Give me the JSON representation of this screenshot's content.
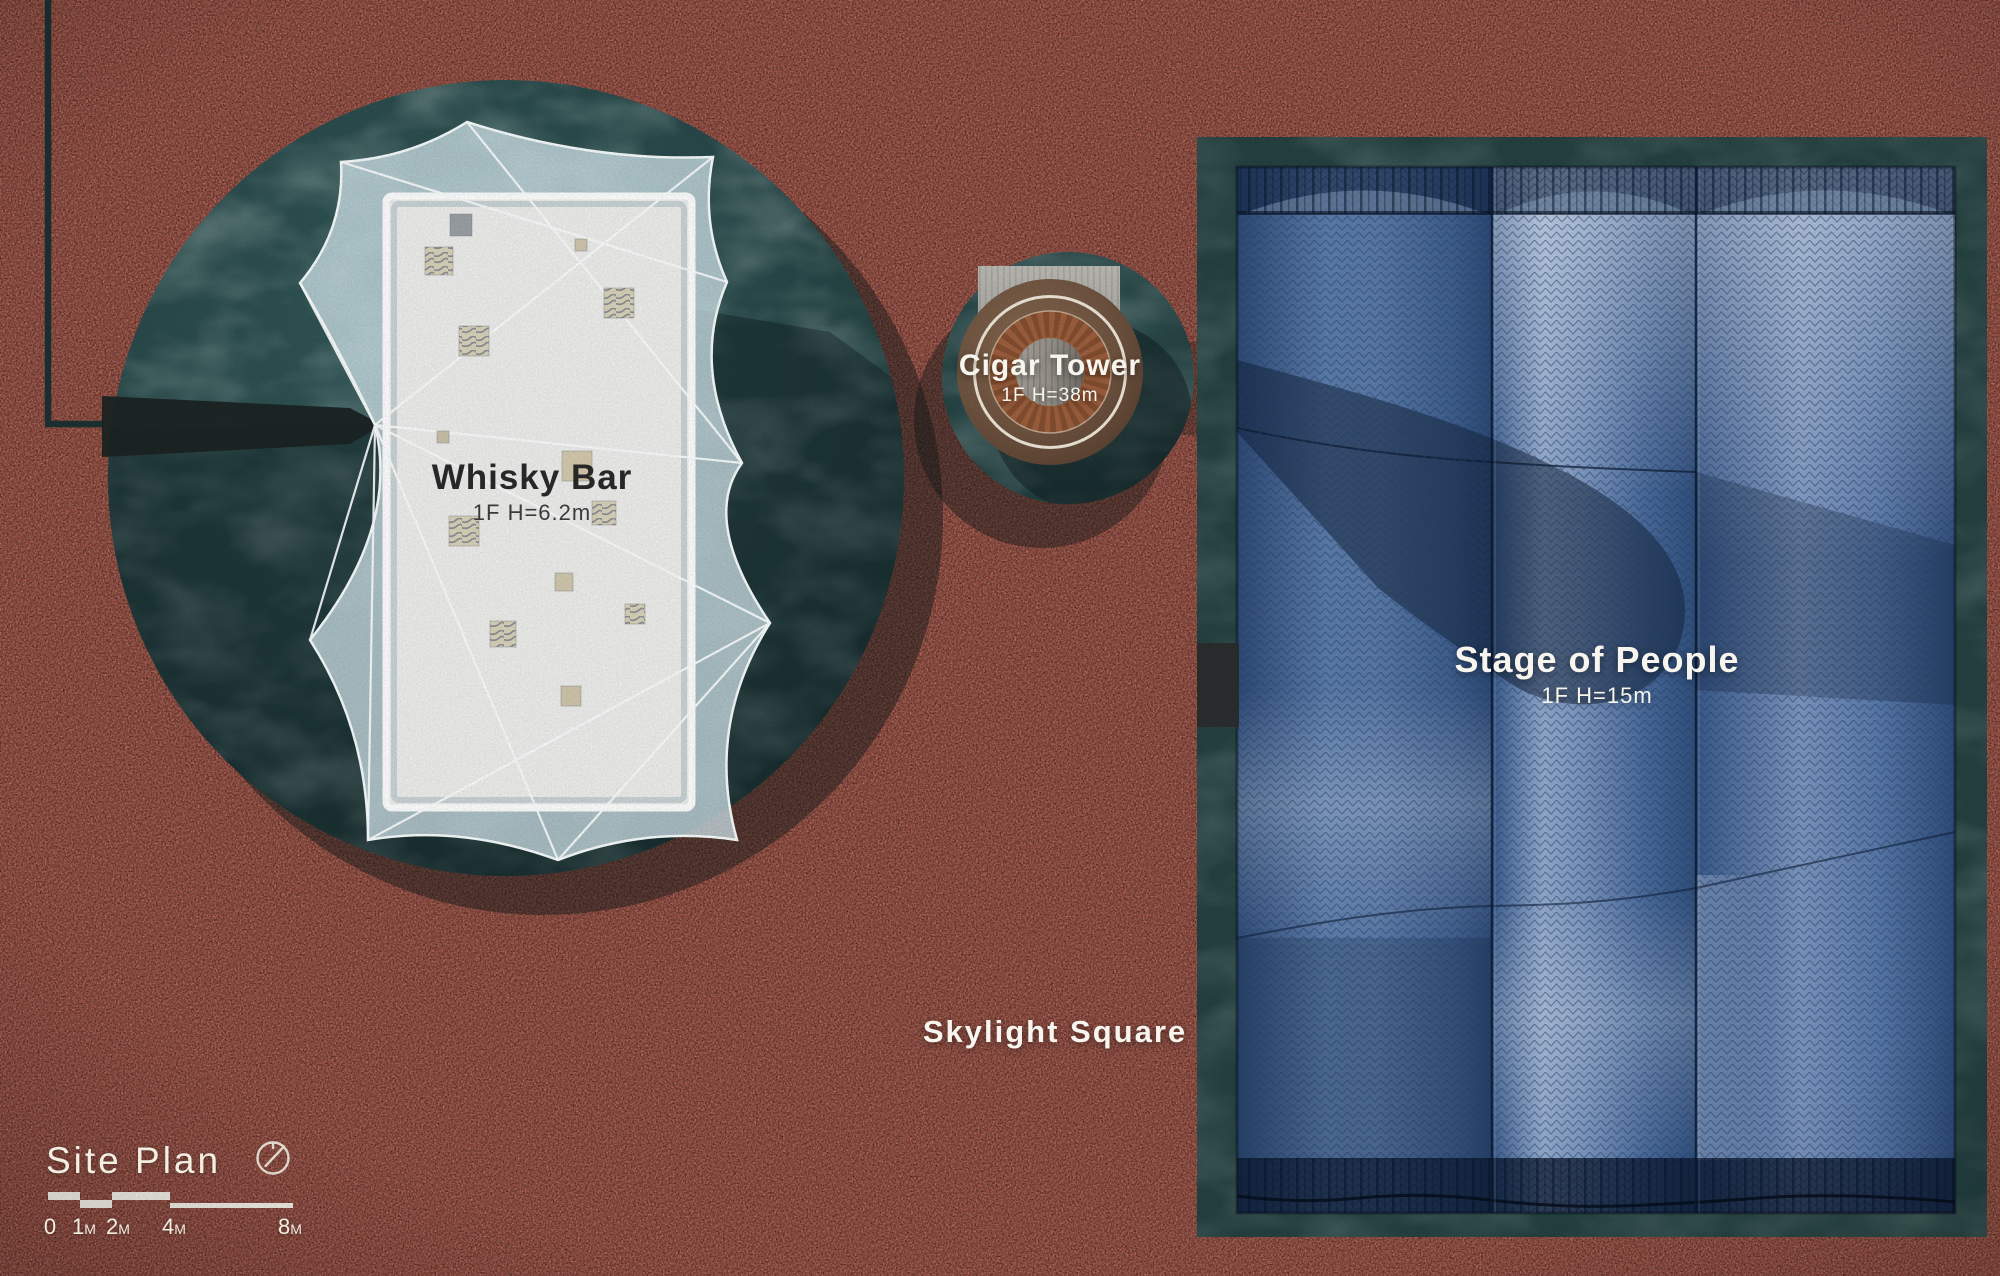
{
  "page": {
    "kind": "architectural-site-plan"
  },
  "colors": {
    "ground_red": "#a5473a",
    "plaza_teal": "#2a4849",
    "stage_frame_teal": "#234140",
    "panel_blue": "#51739f",
    "panel_light": "#a9bdd8",
    "tower_brown": "#77513c",
    "canopy_white": "#ededeb",
    "label_light": "#f7f5ee",
    "label_dark": "#2b2b2b"
  },
  "buildings": {
    "whisky_bar": {
      "label": "Whisky Bar",
      "spec": "1F H=6.2m"
    },
    "cigar_tower": {
      "label": "Cigar Tower",
      "spec": "1F H=38m"
    },
    "stage_of_people": {
      "label": "Stage of People",
      "spec": "1F H=15m"
    }
  },
  "areas": {
    "skylight_square": {
      "label": "Skylight Square"
    }
  },
  "legend": {
    "title": "Site Plan",
    "north_icon": "compass-icon",
    "scale_bar": {
      "ticks": [
        {
          "v": "0",
          "u": ""
        },
        {
          "v": "1",
          "u": "M"
        },
        {
          "v": "2",
          "u": "M"
        },
        {
          "v": "4",
          "u": "M"
        },
        {
          "v": "8",
          "u": "M"
        }
      ]
    }
  }
}
